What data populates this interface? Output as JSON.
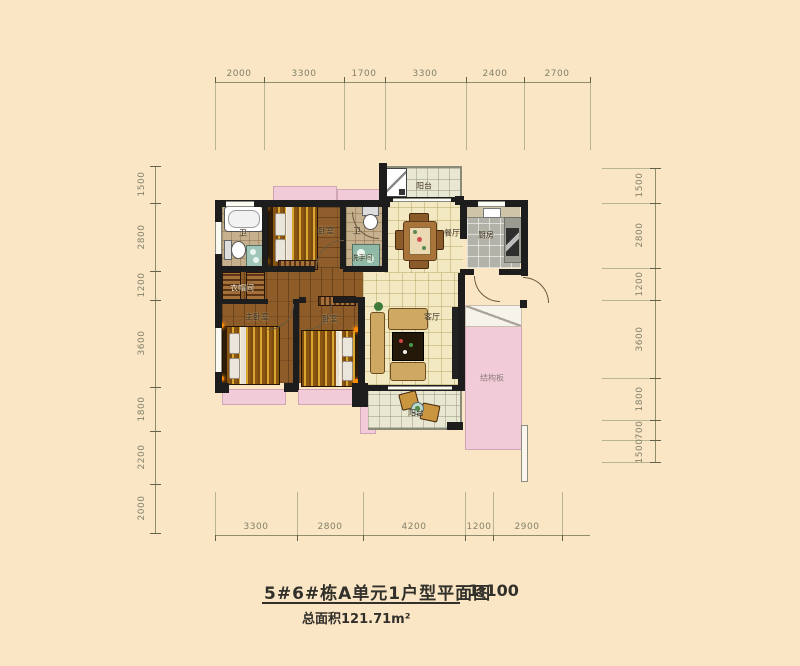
{
  "title": {
    "main": "5#6#栋A单元1户型平面图",
    "scale": "1:100",
    "area": "总面积121.71m²"
  },
  "dimensions": {
    "top": [
      "2000",
      "3300",
      "1700",
      "3300",
      "2400",
      "2700"
    ],
    "bottom": [
      "3300",
      "2800",
      "4200",
      "1200",
      "2900"
    ],
    "left": [
      "1500",
      "2800",
      "1200",
      "3600",
      "1800",
      "2200",
      "2000"
    ],
    "right": [
      "1500",
      "2800",
      "1200",
      "3600",
      "1800",
      "700",
      "1500"
    ]
  },
  "rooms": {
    "balcony_top": "阳台",
    "bath_top": "卫",
    "bedroom_top": "卧室",
    "bath_mid": "卫",
    "washroom": "洗手间",
    "dining": "餐厅",
    "kitchen": "厨房",
    "cloakroom": "衣帽间",
    "master_bedroom": "主卧室",
    "bedroom_second": "卧室",
    "living": "客厅",
    "structural_slab": "结构板",
    "balcony_bottom": "阳台"
  },
  "colors": {
    "background": "#fae6c5",
    "wall": "#1d1d1d",
    "bay_window_pink": "#f1cbd8",
    "wood_floor": "#8d5c28",
    "tile_cream": "#f2e8c2",
    "dimension_olive": "#82826a"
  }
}
